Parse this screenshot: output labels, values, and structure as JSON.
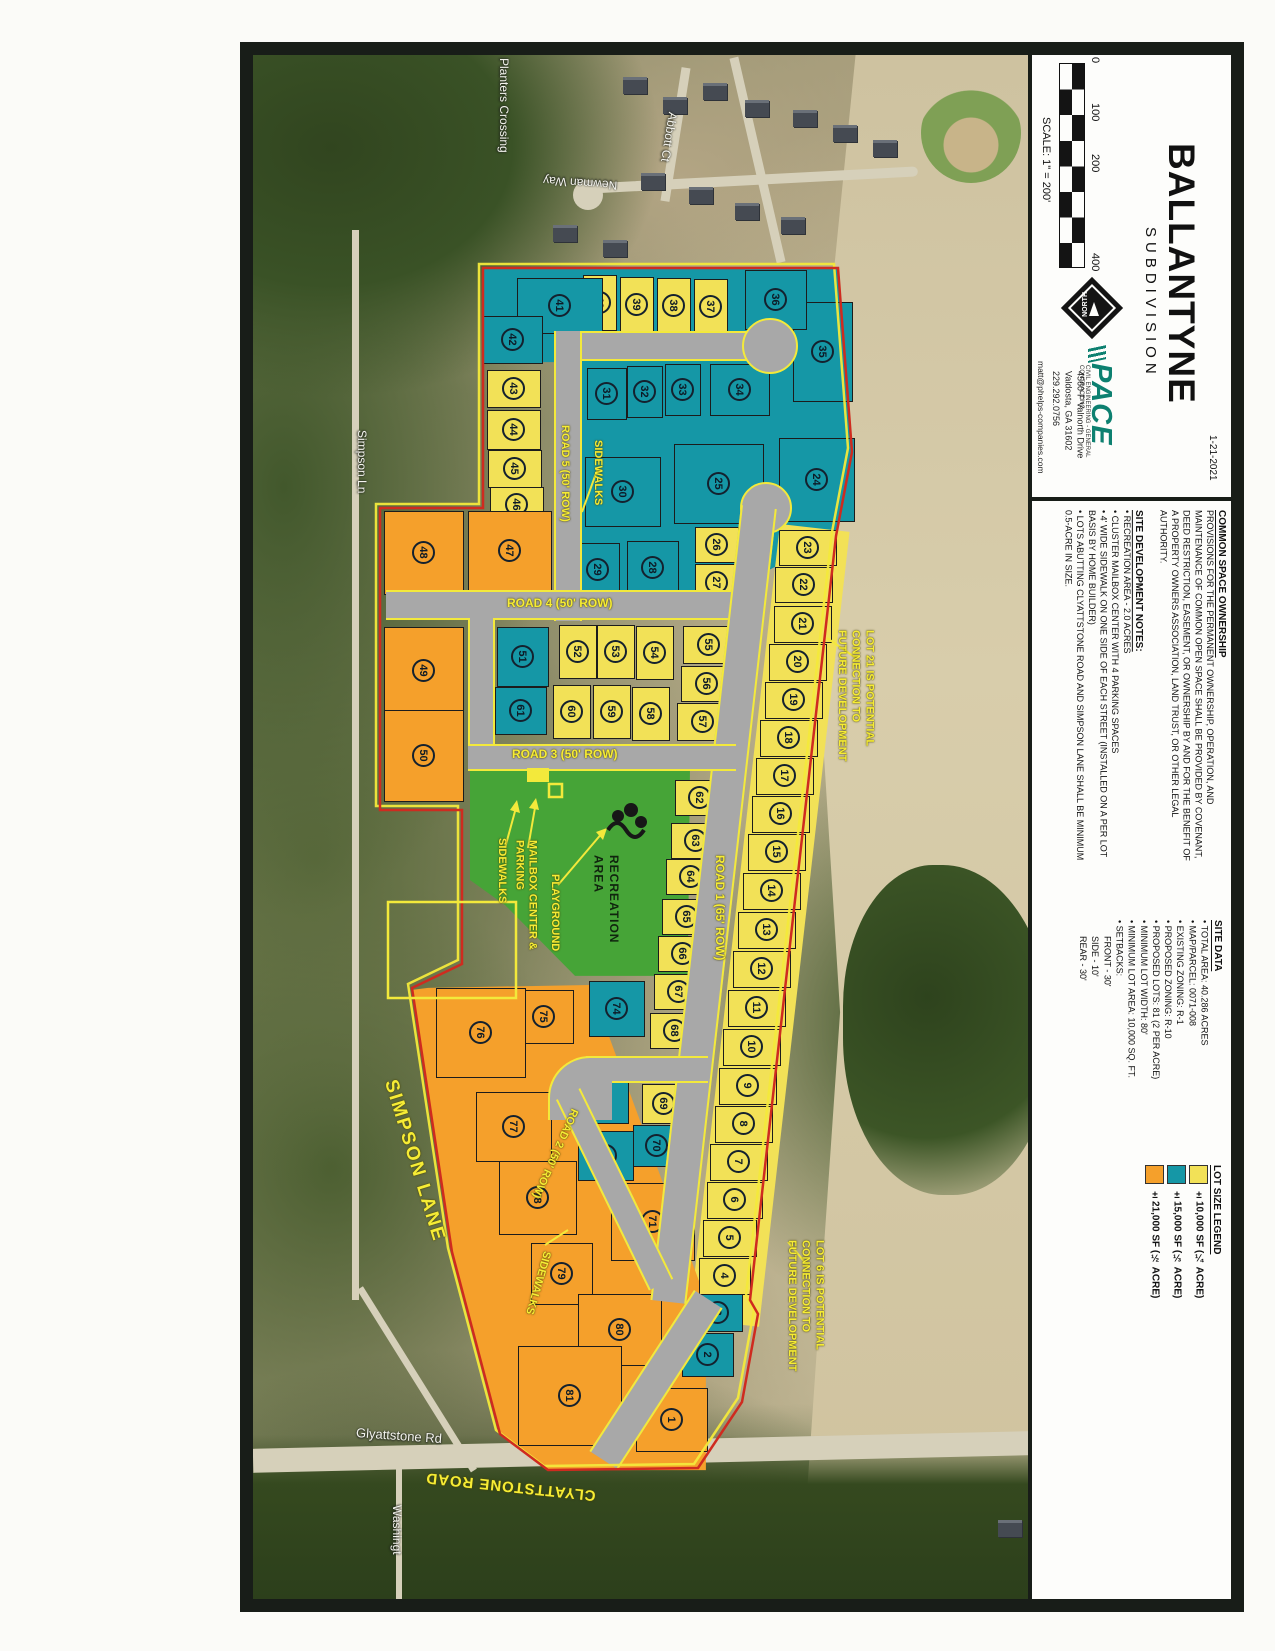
{
  "title_block": {
    "date": "1-21-2021",
    "title": "BALLANTYNE",
    "subtitle": "SUBDIVISION",
    "scale_label": "SCALE: 1\" = 200'",
    "scale_ticks": [
      "0",
      "100",
      "200",
      "400"
    ],
    "north_label": "NORTH",
    "firm": {
      "name": "PACE",
      "tagline": "CIVIL ENGINEERING - GENERAL CONTRACTING",
      "address1": "4560-F Valnorth Drive",
      "address2": "Valdosta, GA  31602",
      "phone": "229.292.0756",
      "email": "matt@phelps-companies.com"
    }
  },
  "common_space": {
    "heading": "COMMON SPACE OWNERSHIP",
    "body": "PROVISIONS FOR THE PERMANENT OWNERSHIP, OPERATION, AND MAINTENANCE OF COMMON OPEN SPACE SHALL BE PROVIDED BY COVENANT, DEED RESTRICTION, EASEMENT, OR OWNERSHIP BY AND FOR THE BENEFIT OF A PROPERTY OWNERS ASSOCIATION, LAND TRUST, OR OTHER LEGAL AUTHORITY."
  },
  "site_notes": {
    "heading": "SITE DEVELOPMENT NOTES:",
    "items": [
      "RECREATION AREA - 2.0 ACRES",
      "CLUSTER MAILBOX CENTER WITH 4 PARKING SPACES",
      "4' WIDE SIDEWALK ON ONE SIDE OF EACH STREET (INSTALLED ON A PER LOT BASIS BY HOME BUILDER)",
      "LOTS ABUTTING CLYATTSTONE ROAD AND SIMPSON LANE SHALL BE MINIMUM 0.5-ACRE IN SIZE."
    ]
  },
  "site_data": {
    "heading": "SITE DATA",
    "items": [
      "TOTAL AREA: 40.286 ACRES",
      "MAP/PARCEL: 0071-008",
      "EXISTING ZONING: R-1",
      "PROPOSED ZONING: R-10",
      "PROPOSED LOTS: 81 (2 PER ACRE)",
      "MINIMUM LOT WIDTH: 80'",
      "MINIMUM LOT AREA: 10,000 SQ. FT.",
      "SETBACKS:"
    ],
    "setbacks": [
      "FRONT - 30'",
      "SIDE - 10'",
      "REAR - 30'"
    ]
  },
  "legend": {
    "heading": "LOT SIZE LEGEND",
    "entries": [
      {
        "label": "±10,000 SF (¼ ACRE)",
        "color": "#f2e157"
      },
      {
        "label": "±15,000 SF (⅓ ACRE)",
        "color": "#1597a6"
      },
      {
        "label": "±21,000 SF (½ ACRE)",
        "color": "#f5a02b"
      }
    ]
  },
  "map": {
    "roads": {
      "road1": "ROAD 1 (65' ROW)",
      "road2": "ROAD 2 (50' ROW)",
      "road3": "ROAD 3 (50' ROW)",
      "road4": "ROAD 4 (50' ROW)",
      "road5": "ROAD 5 (50' ROW)"
    },
    "annotations": {
      "sidewalks": "SIDEWALKS",
      "mailbox": "MAILBOX CENTER & PARKING",
      "playground": "PLAYGROUND",
      "recreation": "RECREATION AREA",
      "lot21_note": [
        "LOT 21 IS POTENTIAL",
        "CONNECTION TO",
        "FUTURE DEVELOPMENT"
      ],
      "lot6_note": [
        "LOT 6 IS POTENTIAL",
        "CONNECTION TO",
        "FUTURE DEVELOPMENT"
      ],
      "simpson_lane": "SIMPSON LANE",
      "clyattstone_road": "CLYATTSTONE ROAD"
    },
    "aerial_labels": {
      "planters": "Planters Crossing",
      "newman": "Newman Way",
      "abbott": "Abbott Ct",
      "simpson_ln": "Simpson Ln",
      "glyattstone": "Glyattstone Rd",
      "washington": "Washingt"
    }
  },
  "palette": {
    "yellow": "#f2e157",
    "teal": "#1597a6",
    "orange": "#f5a02b",
    "green": "#46a437",
    "road_gray": "#a8a8a8",
    "boundary_red": "#cf2b1f",
    "highlight_yellow": "#f3e93b"
  },
  "lots": [
    {
      "n": 1,
      "x": 672,
      "y": 1420,
      "c": "o",
      "w": 72,
      "h": 64
    },
    {
      "n": 2,
      "x": 708,
      "y": 1355,
      "c": "t",
      "w": 52,
      "h": 44
    },
    {
      "n": 3,
      "x": 718,
      "y": 1313,
      "c": "t",
      "w": 50,
      "h": 38
    },
    {
      "n": 4,
      "x": 725,
      "y": 1276,
      "c": "y",
      "w": 52,
      "h": 37
    },
    {
      "n": 5,
      "x": 730,
      "y": 1238,
      "c": "y",
      "w": 54,
      "h": 37
    },
    {
      "n": 6,
      "x": 735,
      "y": 1200,
      "c": "y",
      "w": 56,
      "h": 37
    },
    {
      "n": 7,
      "x": 739,
      "y": 1162,
      "c": "y",
      "w": 58,
      "h": 37
    },
    {
      "n": 8,
      "x": 744,
      "y": 1124,
      "c": "y",
      "w": 58,
      "h": 37
    },
    {
      "n": 9,
      "x": 748,
      "y": 1086,
      "c": "y",
      "w": 58,
      "h": 37
    },
    {
      "n": 10,
      "x": 752,
      "y": 1047,
      "c": "y",
      "w": 58,
      "h": 37
    },
    {
      "n": 11,
      "x": 757,
      "y": 1008,
      "c": "y",
      "w": 58,
      "h": 37
    },
    {
      "n": 12,
      "x": 762,
      "y": 969,
      "c": "y",
      "w": 58,
      "h": 37
    },
    {
      "n": 13,
      "x": 767,
      "y": 930,
      "c": "y",
      "w": 58,
      "h": 37
    },
    {
      "n": 14,
      "x": 772,
      "y": 891,
      "c": "y",
      "w": 58,
      "h": 37
    },
    {
      "n": 15,
      "x": 777,
      "y": 852,
      "c": "y",
      "w": 58,
      "h": 37
    },
    {
      "n": 16,
      "x": 781,
      "y": 814,
      "c": "y",
      "w": 58,
      "h": 37
    },
    {
      "n": 17,
      "x": 785,
      "y": 776,
      "c": "y",
      "w": 58,
      "h": 37
    },
    {
      "n": 18,
      "x": 789,
      "y": 738,
      "c": "y",
      "w": 58,
      "h": 37
    },
    {
      "n": 19,
      "x": 794,
      "y": 700,
      "c": "y",
      "w": 58,
      "h": 37
    },
    {
      "n": 20,
      "x": 798,
      "y": 662,
      "c": "y",
      "w": 58,
      "h": 37
    },
    {
      "n": 21,
      "x": 803,
      "y": 624,
      "c": "y",
      "w": 58,
      "h": 37
    },
    {
      "n": 22,
      "x": 804,
      "y": 585,
      "c": "y",
      "w": 58,
      "h": 36
    },
    {
      "n": 23,
      "x": 808,
      "y": 548,
      "c": "y",
      "w": 58,
      "h": 36
    },
    {
      "n": 24,
      "x": 817,
      "y": 480,
      "c": "t",
      "w": 76,
      "h": 84
    },
    {
      "n": 25,
      "x": 719,
      "y": 484,
      "c": "t",
      "w": 90,
      "h": 80
    },
    {
      "n": 26,
      "x": 717,
      "y": 545,
      "c": "y",
      "w": 44,
      "h": 36
    },
    {
      "n": 27,
      "x": 717,
      "y": 583,
      "c": "y",
      "w": 44,
      "h": 38
    },
    {
      "n": 28,
      "x": 653,
      "y": 568,
      "c": "t",
      "w": 52,
      "h": 54
    },
    {
      "n": 29,
      "x": 598,
      "y": 570,
      "c": "t",
      "w": 44,
      "h": 54
    },
    {
      "n": 30,
      "x": 623,
      "y": 492,
      "c": "t",
      "w": 76,
      "h": 70
    },
    {
      "n": 31,
      "x": 607,
      "y": 394,
      "c": "t",
      "w": 40,
      "h": 52
    },
    {
      "n": 32,
      "x": 645,
      "y": 392,
      "c": "t",
      "w": 36,
      "h": 52
    },
    {
      "n": 33,
      "x": 683,
      "y": 390,
      "c": "t",
      "w": 36,
      "h": 52
    },
    {
      "n": 34,
      "x": 740,
      "y": 390,
      "c": "t",
      "w": 60,
      "h": 52
    },
    {
      "n": 35,
      "x": 823,
      "y": 352,
      "c": "t",
      "w": 60,
      "h": 100
    },
    {
      "n": 36,
      "x": 776,
      "y": 300,
      "c": "t",
      "w": 62,
      "h": 60
    },
    {
      "n": 37,
      "x": 711,
      "y": 307,
      "c": "y",
      "w": 34,
      "h": 56
    },
    {
      "n": 38,
      "x": 674,
      "y": 306,
      "c": "y",
      "w": 34,
      "h": 56
    },
    {
      "n": 39,
      "x": 637,
      "y": 305,
      "c": "y",
      "w": 34,
      "h": 56
    },
    {
      "n": 40,
      "x": 600,
      "y": 303,
      "c": "y",
      "w": 34,
      "h": 56
    },
    {
      "n": 41,
      "x": 560,
      "y": 306,
      "c": "t",
      "w": 86,
      "h": 56
    },
    {
      "n": 42,
      "x": 513,
      "y": 340,
      "c": "t",
      "w": 60,
      "h": 48
    },
    {
      "n": 43,
      "x": 514,
      "y": 389,
      "c": "y",
      "w": 54,
      "h": 38
    },
    {
      "n": 44,
      "x": 514,
      "y": 430,
      "c": "y",
      "w": 54,
      "h": 40
    },
    {
      "n": 45,
      "x": 515,
      "y": 469,
      "c": "y",
      "w": 54,
      "h": 38
    },
    {
      "n": 46,
      "x": 517,
      "y": 505,
      "c": "y",
      "w": 54,
      "h": 36
    },
    {
      "n": 47,
      "x": 510,
      "y": 551,
      "c": "o",
      "w": 84,
      "h": 80
    },
    {
      "n": 48,
      "x": 424,
      "y": 553,
      "c": "o",
      "w": 80,
      "h": 84
    },
    {
      "n": 49,
      "x": 424,
      "y": 671,
      "c": "o",
      "w": 80,
      "h": 88
    },
    {
      "n": 50,
      "x": 424,
      "y": 756,
      "c": "o",
      "w": 80,
      "h": 92
    },
    {
      "n": 51,
      "x": 523,
      "y": 657,
      "c": "t",
      "w": 52,
      "h": 60
    },
    {
      "n": 52,
      "x": 578,
      "y": 652,
      "c": "y",
      "w": 38,
      "h": 54
    },
    {
      "n": 53,
      "x": 616,
      "y": 652,
      "c": "y",
      "w": 38,
      "h": 54
    },
    {
      "n": 54,
      "x": 655,
      "y": 653,
      "c": "y",
      "w": 38,
      "h": 54
    },
    {
      "n": 55,
      "x": 709,
      "y": 645,
      "c": "y",
      "w": 52,
      "h": 38
    },
    {
      "n": 56,
      "x": 707,
      "y": 684,
      "c": "y",
      "w": 52,
      "h": 36
    },
    {
      "n": 57,
      "x": 703,
      "y": 722,
      "c": "y",
      "w": 52,
      "h": 38
    },
    {
      "n": 58,
      "x": 651,
      "y": 714,
      "c": "y",
      "w": 38,
      "h": 54
    },
    {
      "n": 59,
      "x": 612,
      "y": 712,
      "c": "y",
      "w": 38,
      "h": 54
    },
    {
      "n": 60,
      "x": 572,
      "y": 712,
      "c": "y",
      "w": 38,
      "h": 54
    },
    {
      "n": 61,
      "x": 521,
      "y": 711,
      "c": "t",
      "w": 52,
      "h": 48
    },
    {
      "n": 62,
      "x": 700,
      "y": 798,
      "c": "y",
      "w": 50,
      "h": 36
    },
    {
      "n": 63,
      "x": 696,
      "y": 841,
      "c": "y",
      "w": 50,
      "h": 36
    },
    {
      "n": 64,
      "x": 691,
      "y": 877,
      "c": "y",
      "w": 50,
      "h": 36
    },
    {
      "n": 65,
      "x": 687,
      "y": 917,
      "c": "y",
      "w": 50,
      "h": 36
    },
    {
      "n": 66,
      "x": 683,
      "y": 954,
      "c": "y",
      "w": 50,
      "h": 36
    },
    {
      "n": 67,
      "x": 679,
      "y": 992,
      "c": "y",
      "w": 50,
      "h": 36
    },
    {
      "n": 68,
      "x": 675,
      "y": 1031,
      "c": "y",
      "w": 50,
      "h": 36
    },
    {
      "n": 69,
      "x": 664,
      "y": 1104,
      "c": "y",
      "w": 44,
      "h": 40
    },
    {
      "n": 70,
      "x": 657,
      "y": 1146,
      "c": "t",
      "w": 48,
      "h": 42
    },
    {
      "n": 71,
      "x": 653,
      "y": 1222,
      "c": "o",
      "w": 84,
      "h": 78
    },
    {
      "n": 72,
      "x": 606,
      "y": 1156,
      "c": "t",
      "w": 56,
      "h": 50
    },
    {
      "n": 73,
      "x": 601,
      "y": 1100,
      "c": "t",
      "w": 56,
      "h": 48
    },
    {
      "n": 74,
      "x": 617,
      "y": 1009,
      "c": "t",
      "w": 56,
      "h": 56
    },
    {
      "n": 75,
      "x": 544,
      "y": 1017,
      "c": "o",
      "w": 60,
      "h": 54
    },
    {
      "n": 76,
      "x": 481,
      "y": 1033,
      "c": "o",
      "w": 90,
      "h": 90
    },
    {
      "n": 77,
      "x": 514,
      "y": 1127,
      "c": "o",
      "w": 76,
      "h": 70
    },
    {
      "n": 78,
      "x": 538,
      "y": 1198,
      "c": "o",
      "w": 78,
      "h": 74
    },
    {
      "n": 79,
      "x": 562,
      "y": 1274,
      "c": "o",
      "w": 62,
      "h": 62
    },
    {
      "n": 80,
      "x": 620,
      "y": 1330,
      "c": "o",
      "w": 84,
      "h": 72
    },
    {
      "n": 81,
      "x": 570,
      "y": 1396,
      "c": "o",
      "w": 104,
      "h": 100
    }
  ]
}
